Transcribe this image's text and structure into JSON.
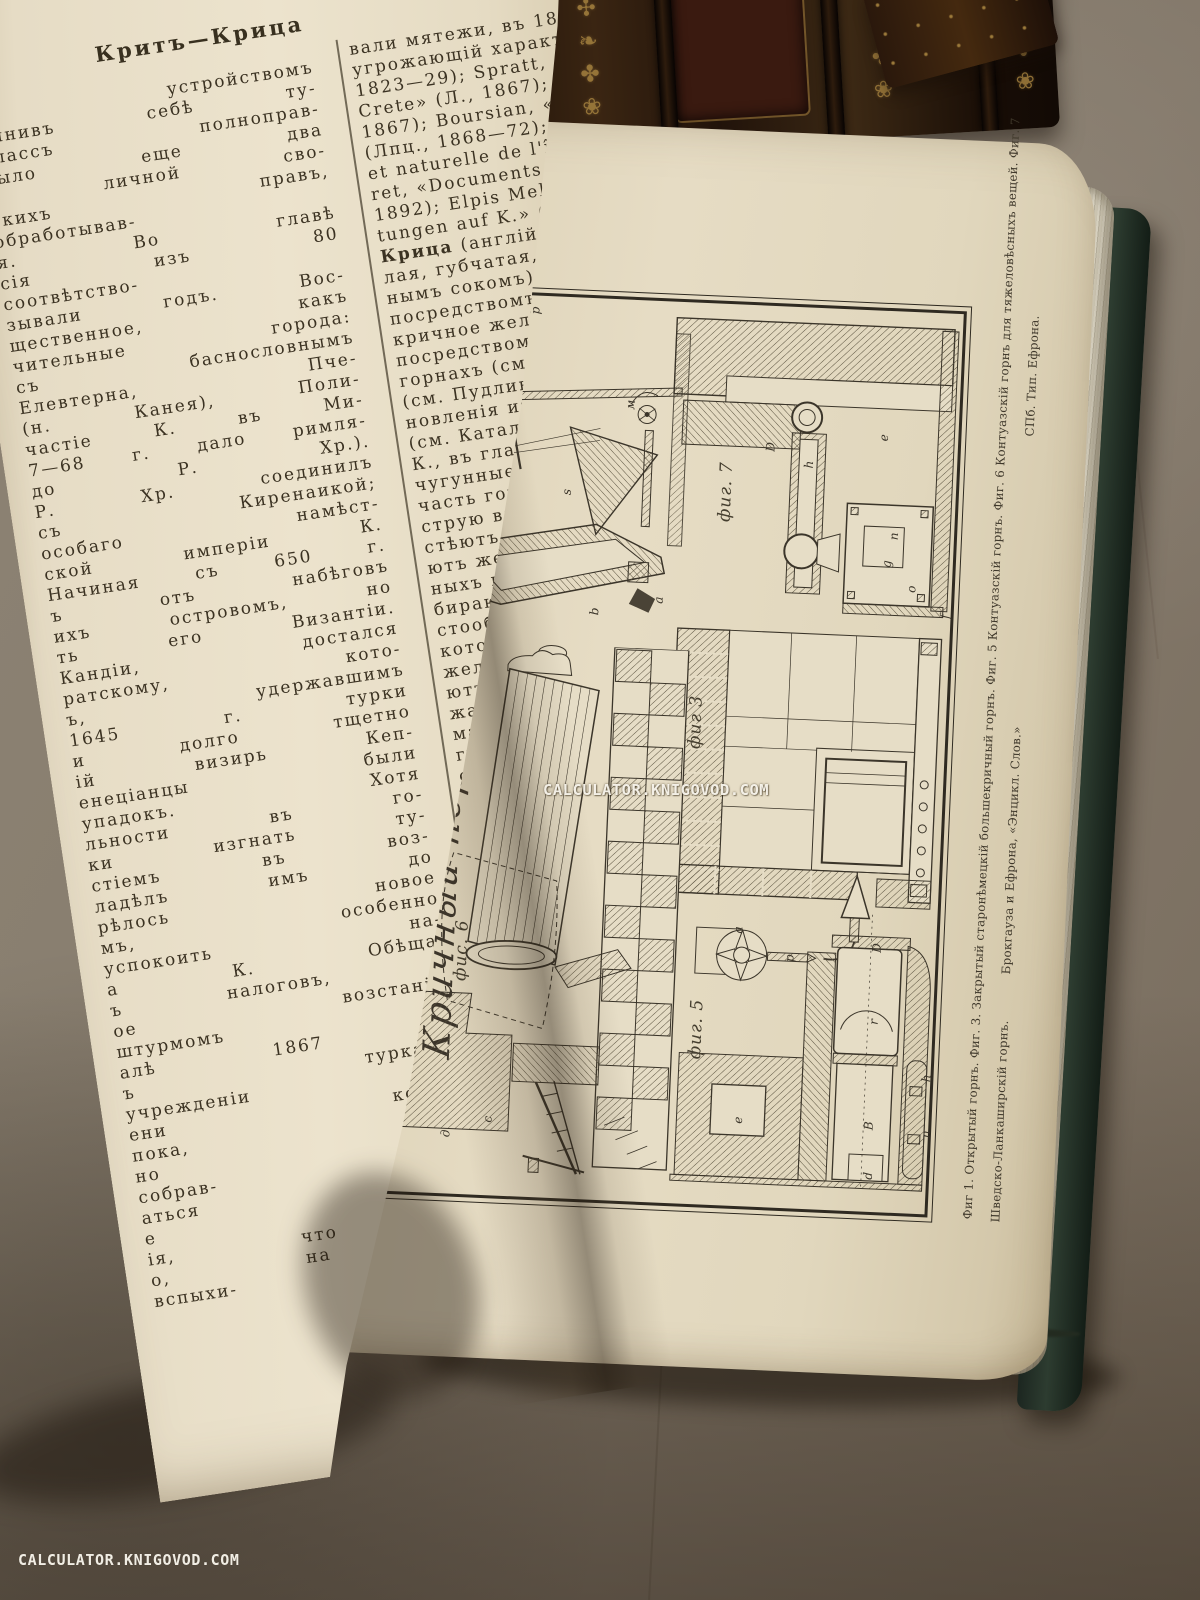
{
  "left_page": {
    "header": "Критъ—Крица",
    "column1": "ъ устройствомъ\nчинивъ себѣ ту-\nклассъ полноправ-\nбыло еще два\nй личной сво-\nскихъ правъ,\nобработывав-\nя. Во главѣ\nсія изъ 80\nсоотвѣтство-\nзывали годъ. Вос-\nщественное, какъ\nчительные города:\nсъ баснословнымъ\nЕлевтерна, Пче-\n(н. Канея), Поли-\nчастіе К. въ Ми-\n7—68 г. дало римля-\nдо Р. Хр.).\nР. Хр. соединилъ\nсъ Киренаикой;\nособаго намѣст-\nской имперіи К.\nНачиная съ 650 г.\nъ отъ набѣговъ\nихъ островомъ, но\nть его Византіи.\nКандіи, достался\nратскому, кото-\nъ, удержавшимъ\n1645 г. турки\nи долго тщетно\nій визирь Кеп-\nенеціанцы были\nупадокъ. Хотя\nльности въ го-\nки изгнать ту-\nстіемъ въ воз-\nладѣлъ имъ до\nрѣлось новое\nмъ, особенно\nуспокоить на-\nа К. Обѣща-\nъ налоговъ, и\nое возстаніе,\nштурмомъ\nалѣ 1867 г.\nъ турками;\nучрежденіи\nени короля\nпока, на-\nно рѣши-\nсобрав-\nаться отъ\nе критянъ\nія, что К.\nо, на К.\nвспыхи-",
    "column2_pre": "вали мятежи, въ 1887 и\nугрожающій характеръ (ср.\n1823—29); Spratt, «Travels\nCrete» (Л., 1867);\n1867); Boursian, «Ge-\n(Лпц., 1868—72); Per-\net naturelle de l'île de\nret, «Documents inédits\n1892); Elpis Melena, «E-\ntungen auf K.» (Ганнов.\n",
    "column2_term": "Крица",
    "column2_rest": " (англійск. loup,\nлая, губчатая, пропитан-\nнымъ сокомъ) желѣзная\nпосредствомъ разныхъ\nкричное желѣзо или сталь\nпосредствомъ сжиманія\nгорнахъ (см. Горнъ) и въ\n(см. Пудлингованіе), или\nновленія изъ рудъ въ с\n(см. Каталанскій способъ\nК., въ главныхъ чертахъ\nчугунные слитки (свинки)\nчасть горна. Чугунныя кап\nструю вдуваемаго воздуха\nстѣютъ, свариваются межд\nютъ желѣзные сгустки, пер\nныхъ примѣсей чугуна. Ж\nбираютъ или накатыва\nстообразный комъ, назыв\nкоторая не представляетъ\nжелѣза, а только желѣзист\nютъ комъ на верхъ горна\nжаго угля и вывариваютъ\nматеріала. Въ зависимости\nгуна, количества насадки и\nсколько разъ, пока не дов\nлежащей спѣлости. Подгот\nжелѣзная масса вообще наз\nломъ, товаромъ или припас\nбуютъ ломомъ: если ломъ\nматеріалъ до самаго дна\nприставшія къ лому частицы\nцвѣта и съ трудомъ отдѣл\nчто матеріалъ еще не готовъ\nматеріалъ готовъ, т. е.\nно-бѣлаго цвѣта, а конс\nшицеобразна. Крица предст\nный губчатый сфероидальн\nняя — горбомъ, у подфурмен\nна — фурмою, у противофурм\nу задней доски — головой\nнимъ бокамъ. Готовую К.\nклещами, подвергаютъ мех\nт. е. обжимкѣ подъ кричн\nудаленія изъ нея шлака и\nсобой отдѣльныхъ частицъ\nютъ квадратнаго сѣченія\nсокъ, называемый кричной"
  },
  "plate": {
    "title_script": "Кричный передѣлъ.",
    "figures": [
      {
        "id": "fig1",
        "label": "фиг. 1",
        "letters": [
          {
            "t": "p",
            "x": 52,
            "y": 14
          },
          {
            "t": "p",
            "x": 78,
            "y": 6
          },
          {
            "t": "м",
            "x": 176,
            "y": 96
          },
          {
            "t": "s",
            "x": 118,
            "y": 186
          },
          {
            "t": "a",
            "x": 214,
            "y": 290
          },
          {
            "t": "b",
            "x": 150,
            "y": 304
          }
        ]
      },
      {
        "id": "fig7",
        "label": "фиг. 7",
        "letters": [
          {
            "t": "D",
            "x": 100,
            "y": 126
          },
          {
            "t": "h",
            "x": 140,
            "y": 142
          },
          {
            "t": "e",
            "x": 214,
            "y": 112
          },
          {
            "t": "n",
            "x": 228,
            "y": 210
          },
          {
            "t": "g",
            "x": 222,
            "y": 238
          },
          {
            "t": "o",
            "x": 248,
            "y": 262
          },
          {
            "t": "f",
            "x": 284,
            "y": 288
          }
        ]
      },
      {
        "id": "fig3",
        "label": "фиг 3",
        "letters": []
      },
      {
        "id": "fig5",
        "label": "фиг. 5",
        "letters": [
          {
            "t": "a",
            "x": 58,
            "y": 18
          },
          {
            "t": "p",
            "x": 110,
            "y": 44
          },
          {
            "t": "D",
            "x": 196,
            "y": 30
          },
          {
            "t": "r",
            "x": 198,
            "y": 104
          },
          {
            "t": "e",
            "x": 66,
            "y": 208
          },
          {
            "t": "B",
            "x": 196,
            "y": 208
          },
          {
            "t": "h",
            "x": 252,
            "y": 158
          },
          {
            "t": "n",
            "x": 254,
            "y": 214
          },
          {
            "t": "d",
            "x": 198,
            "y": 258
          }
        ]
      },
      {
        "id": "fig6",
        "label": "фис. 6",
        "letters": [
          {
            "t": "c",
            "x": 100,
            "y": 470
          },
          {
            "t": "д",
            "x": 58,
            "y": 486
          }
        ]
      }
    ],
    "caption_line1": "Фиг 1. Открытый горнъ.   Фиг. 3. Закрытый старонѣмецкій большекричный горнъ.   Фиг. 5 Контуазскій горнъ.   Фиг. 6 Контуазскій горнъ для тяжеловѣсныхъ вещей.   Фиг. 7",
    "caption_line2": "Шведско-Ланкаширскій горнъ.",
    "credit_publisher": "Брокгауза и Ефрона, «Энцикл. Слов.»",
    "credit_printer": "СПб. Тип. Ефрона."
  },
  "watermark": {
    "center": "CALCULATOR.KNIGOVOD.COM",
    "bottom": "CALCULATOR.KNIGOVOD.COM"
  },
  "decor": {
    "spine_glyphs": "❦✣❧✤❀"
  },
  "colors": {
    "backdrop": "#877d6e",
    "backdrop_dark": "#6e6254",
    "spine_leather": "#271a10",
    "spine_gold": "#a8813e",
    "page_left": "#e8dfc8",
    "page_right": "#e3d9c0",
    "fore_edge": "#cdc6b3",
    "cover_green": "#2d3c30",
    "ink": "#3b3222",
    "plate_ink": "#3b352a",
    "watermark": "#faf7ee"
  }
}
